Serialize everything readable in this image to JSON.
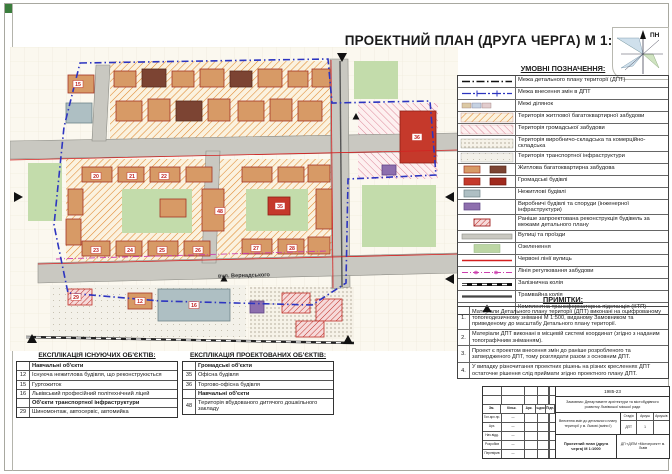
{
  "title": "ПРОЕКТНИЙ ПЛАН (ДРУГА ЧЕРГА) М 1:1000",
  "north_label": "ПН",
  "legend": {
    "title": "УМОВНІ ПОЗНАЧЕННЯ:",
    "items": [
      {
        "sw": "line-black",
        "label": "Межа детального плану території (ДПТ)"
      },
      {
        "sw": "line-blue",
        "label": "Межа внесення змін в ДПТ"
      },
      {
        "sw": "parcels",
        "label": "Межі ділянок"
      },
      {
        "sw": "hatch-orange",
        "label": "Територія житлової багатоквартирної забудови"
      },
      {
        "sw": "hatch-pink",
        "label": "Територія громадської забудови"
      },
      {
        "sw": "dots-dense",
        "label": "Територія виробничо-складська та комерційно-складська"
      },
      {
        "sw": "dots-light",
        "label": "Територія транспортної інфраструктури"
      },
      {
        "sw": "rects-tan",
        "label": "Житлова багатоквартирна забудова"
      },
      {
        "sw": "rects-red",
        "label": "Громадські будівлі"
      },
      {
        "sw": "rect-gray",
        "label": "Нежитлові будівлі"
      },
      {
        "sw": "rect-purple",
        "label": "Виробничі будівлі та споруди (інженерної інфраструктури)"
      },
      {
        "sw": "rect-darkred",
        "label": "Раніше запроектована реконструкція будівель за межами детального плану"
      },
      {
        "sw": "bar-gray",
        "label": "Вулиці та проїзди"
      },
      {
        "sw": "fill-green",
        "label": "Озеленення"
      },
      {
        "sw": "line-red",
        "label": "Червоні лінії вулиць"
      },
      {
        "sw": "line-magenta",
        "label": "Лінія регулювання забудови"
      },
      {
        "sw": "rail",
        "label": "Залізнична колія"
      },
      {
        "sw": "tram",
        "label": "Трамвайна колія"
      },
      {
        "sw": "ktp",
        "label": "Комплектна трансформаторна підстанція (КТП)"
      }
    ]
  },
  "notes": {
    "title": "ПРИМІТКИ:",
    "items": [
      {
        "num": "1.",
        "text": "Матеріали Детального плану території (ДПТ) виконані на оцифрованому топогеодезичному зніманні М 1:500, виданому Замовником та приведеному до масштабу Детального плану території."
      },
      {
        "num": "2.",
        "text": "Матеріали ДПТ виконані в місцевій системі координат (згідно з наданим топографічним зніманням)."
      },
      {
        "num": "3.",
        "text": "Проект є проектом внесення змін до раніше розробленого та затвердженого ДПТ, тому розглядати разом з основним ДПТ."
      },
      {
        "num": "4.",
        "text": "У випадку різночитання проектних рішень на різних кресленнях ДПТ остаточне рішення слід приймати згідно проектного плану ДПТ."
      }
    ]
  },
  "explication_existing": {
    "title": "ЕКСПЛІКАЦІЯ ІСНУЮЧИХ ОБ'ЄКТІВ:",
    "rows": [
      {
        "num": "",
        "label": "Навчальні об'єкти",
        "section": true
      },
      {
        "num": "12",
        "label": "Існуюча нежитлова будівля, що реконструюється",
        "section": false
      },
      {
        "num": "15",
        "label": "Гуртожиток",
        "section": false
      },
      {
        "num": "16",
        "label": "Львівський професійний політехнічний ліцей",
        "section": false
      },
      {
        "num": "",
        "label": "Об'єкти транспортної інфраструктури",
        "section": true
      },
      {
        "num": "29",
        "label": "Шиномонтаж, автосервіс, автомийка",
        "section": false
      }
    ]
  },
  "explication_projected": {
    "title": "ЕКСПЛІКАЦІЯ ПРОЕКТОВАНИХ ОБ'ЄКТІВ:",
    "rows": [
      {
        "num": "",
        "label": "Громадські об'єкти",
        "section": true
      },
      {
        "num": "35",
        "label": "Офісна будівля",
        "section": false
      },
      {
        "num": "36",
        "label": "Торгово-офісна будівля",
        "section": false
      },
      {
        "num": "",
        "label": "Навчальні об'єкти",
        "section": true
      },
      {
        "num": "48",
        "label": "Територія вбудованого дитячого дошкільного закладу",
        "section": false
      }
    ]
  },
  "stamp": {
    "code": "1985-23",
    "client": "Замовник: Департамент архітектури та містобудівного розвитку Львівської міської ради",
    "project": "Внесення змін до детального плану території у м. Львові (зміни І)",
    "stage_h": "Стадія",
    "sheet_h": "Аркуш",
    "sheets_h": "Аркушів",
    "stage": "ДПТ",
    "sheet": "1",
    "sheets": "",
    "sheet_name": "Проектний план (друга черга) М 1:1000",
    "org": "ДП «ДІПМ «Містопроект» м. Львів",
    "cols": [
      "Зм.",
      "Кільк.",
      "Арк.",
      "№док.",
      "Підп.",
      "Дата"
    ],
    "rows": [
      [
        "Гол.арх.пр.",
        "—"
      ],
      [
        "Арх.",
        "—"
      ],
      [
        "Нач.відд.",
        "—"
      ],
      [
        "Розробив",
        "—"
      ],
      [
        "Перевірив",
        "—"
      ]
    ]
  },
  "map": {
    "street_label": {
      "text": "вул. Вернадського",
      "x": 234,
      "y": 230,
      "rot": -1.5
    },
    "zones": [
      {
        "x": 100,
        "y": 14,
        "w": 222,
        "h": 84,
        "f": "hO"
      },
      {
        "x": 56,
        "y": 112,
        "w": 268,
        "h": 106,
        "f": "hO"
      },
      {
        "x": 348,
        "y": 56,
        "w": 80,
        "h": 76,
        "f": "hP"
      },
      {
        "x": 240,
        "y": 240,
        "w": 104,
        "h": 52,
        "f": "dD"
      },
      {
        "x": 40,
        "y": 238,
        "w": 196,
        "h": 52,
        "f": "dG"
      },
      {
        "x": 112,
        "y": 142,
        "w": 70,
        "h": 44,
        "f": "G"
      },
      {
        "x": 236,
        "y": 142,
        "w": 62,
        "h": 42,
        "f": "G"
      },
      {
        "x": 352,
        "y": 138,
        "w": 74,
        "h": 62,
        "f": "G"
      },
      {
        "x": 18,
        "y": 116,
        "w": 34,
        "h": 58,
        "f": "G"
      },
      {
        "x": 344,
        "y": 14,
        "w": 44,
        "h": 38,
        "f": "G"
      }
    ],
    "streets": [
      "0,94 448,86 448,104 0,112",
      "320,12 338,12 340,240 322,242",
      "28,216 448,206 448,226 28,236",
      "86,18 100,18 96,94 82,94",
      "196,104 210,104 206,216 192,216"
    ],
    "boundary": "70,16 318,12 322,56 420,54 426,128 338,132 336,236 302,258 150,254 58,246 44,178 54,80",
    "redlines": [
      "0,113 448,103",
      "28,217 448,207",
      "321,13 323,241"
    ],
    "regline": "46,212 318,204",
    "rail": [
      16,
      290,
      344,
      296
    ],
    "tram": [
      330,
      14,
      332,
      240
    ],
    "buildings": [
      [
        104,
        24,
        22,
        16,
        "t"
      ],
      [
        132,
        22,
        24,
        18,
        "d"
      ],
      [
        162,
        24,
        22,
        16,
        "t"
      ],
      [
        190,
        22,
        24,
        18,
        "t"
      ],
      [
        220,
        24,
        22,
        16,
        "d"
      ],
      [
        248,
        22,
        24,
        18,
        "t"
      ],
      [
        278,
        24,
        20,
        16,
        "t"
      ],
      [
        302,
        22,
        18,
        18,
        "t"
      ],
      [
        106,
        54,
        26,
        20,
        "t"
      ],
      [
        138,
        52,
        22,
        22,
        "t"
      ],
      [
        166,
        54,
        26,
        20,
        "d"
      ],
      [
        198,
        52,
        22,
        22,
        "t"
      ],
      [
        228,
        54,
        26,
        20,
        "t"
      ],
      [
        260,
        52,
        22,
        22,
        "t"
      ],
      [
        288,
        54,
        24,
        20,
        "t"
      ],
      [
        58,
        28,
        26,
        18,
        "t"
      ],
      [
        56,
        56,
        26,
        20,
        "g"
      ],
      [
        390,
        64,
        36,
        52,
        "r"
      ],
      [
        72,
        120,
        30,
        15,
        "t"
      ],
      [
        108,
        120,
        26,
        15,
        "t"
      ],
      [
        140,
        120,
        30,
        15,
        "t"
      ],
      [
        176,
        120,
        26,
        15,
        "t"
      ],
      [
        232,
        120,
        30,
        15,
        "t"
      ],
      [
        268,
        120,
        26,
        15,
        "t"
      ],
      [
        298,
        118,
        22,
        17,
        "t"
      ],
      [
        58,
        142,
        15,
        26,
        "t"
      ],
      [
        56,
        172,
        15,
        26,
        "t"
      ],
      [
        72,
        194,
        28,
        15,
        "t"
      ],
      [
        106,
        194,
        26,
        15,
        "t"
      ],
      [
        138,
        194,
        30,
        15,
        "t"
      ],
      [
        174,
        194,
        26,
        15,
        "t"
      ],
      [
        232,
        192,
        30,
        15,
        "t"
      ],
      [
        268,
        192,
        26,
        15,
        "t"
      ],
      [
        298,
        190,
        22,
        17,
        "t"
      ],
      [
        192,
        142,
        22,
        42,
        "t"
      ],
      [
        150,
        152,
        26,
        18,
        "t"
      ],
      [
        258,
        150,
        22,
        18,
        "r"
      ],
      [
        306,
        142,
        16,
        40,
        "t"
      ],
      [
        148,
        242,
        72,
        32,
        "g"
      ],
      [
        118,
        246,
        24,
        16,
        "t"
      ],
      [
        272,
        246,
        28,
        20,
        "h"
      ],
      [
        306,
        252,
        26,
        22,
        "h"
      ],
      [
        286,
        274,
        28,
        16,
        "h"
      ],
      [
        240,
        254,
        14,
        12,
        "p"
      ],
      [
        372,
        118,
        14,
        10,
        "p"
      ],
      [
        58,
        242,
        24,
        16,
        "h"
      ]
    ],
    "numbers": [
      [
        86,
        131,
        "20"
      ],
      [
        122,
        131,
        "21"
      ],
      [
        154,
        131,
        "22"
      ],
      [
        86,
        205,
        "23"
      ],
      [
        120,
        205,
        "24"
      ],
      [
        152,
        205,
        "25"
      ],
      [
        188,
        205,
        "26"
      ],
      [
        246,
        203,
        "27"
      ],
      [
        282,
        203,
        "28"
      ],
      [
        270,
        161,
        "35"
      ],
      [
        407,
        92,
        "36"
      ],
      [
        210,
        166,
        "48"
      ],
      [
        184,
        260,
        "16"
      ],
      [
        130,
        256,
        "12"
      ],
      [
        68,
        39,
        "15"
      ],
      [
        66,
        252,
        "29"
      ]
    ],
    "ktp": [
      [
        346,
        70
      ],
      [
        214,
        232
      ]
    ],
    "corners": [
      [
        4,
        150,
        90
      ],
      [
        332,
        6,
        180
      ],
      [
        444,
        150,
        270
      ],
      [
        444,
        232,
        270
      ],
      [
        22,
        296,
        0
      ],
      [
        338,
        297,
        0
      ]
    ]
  }
}
